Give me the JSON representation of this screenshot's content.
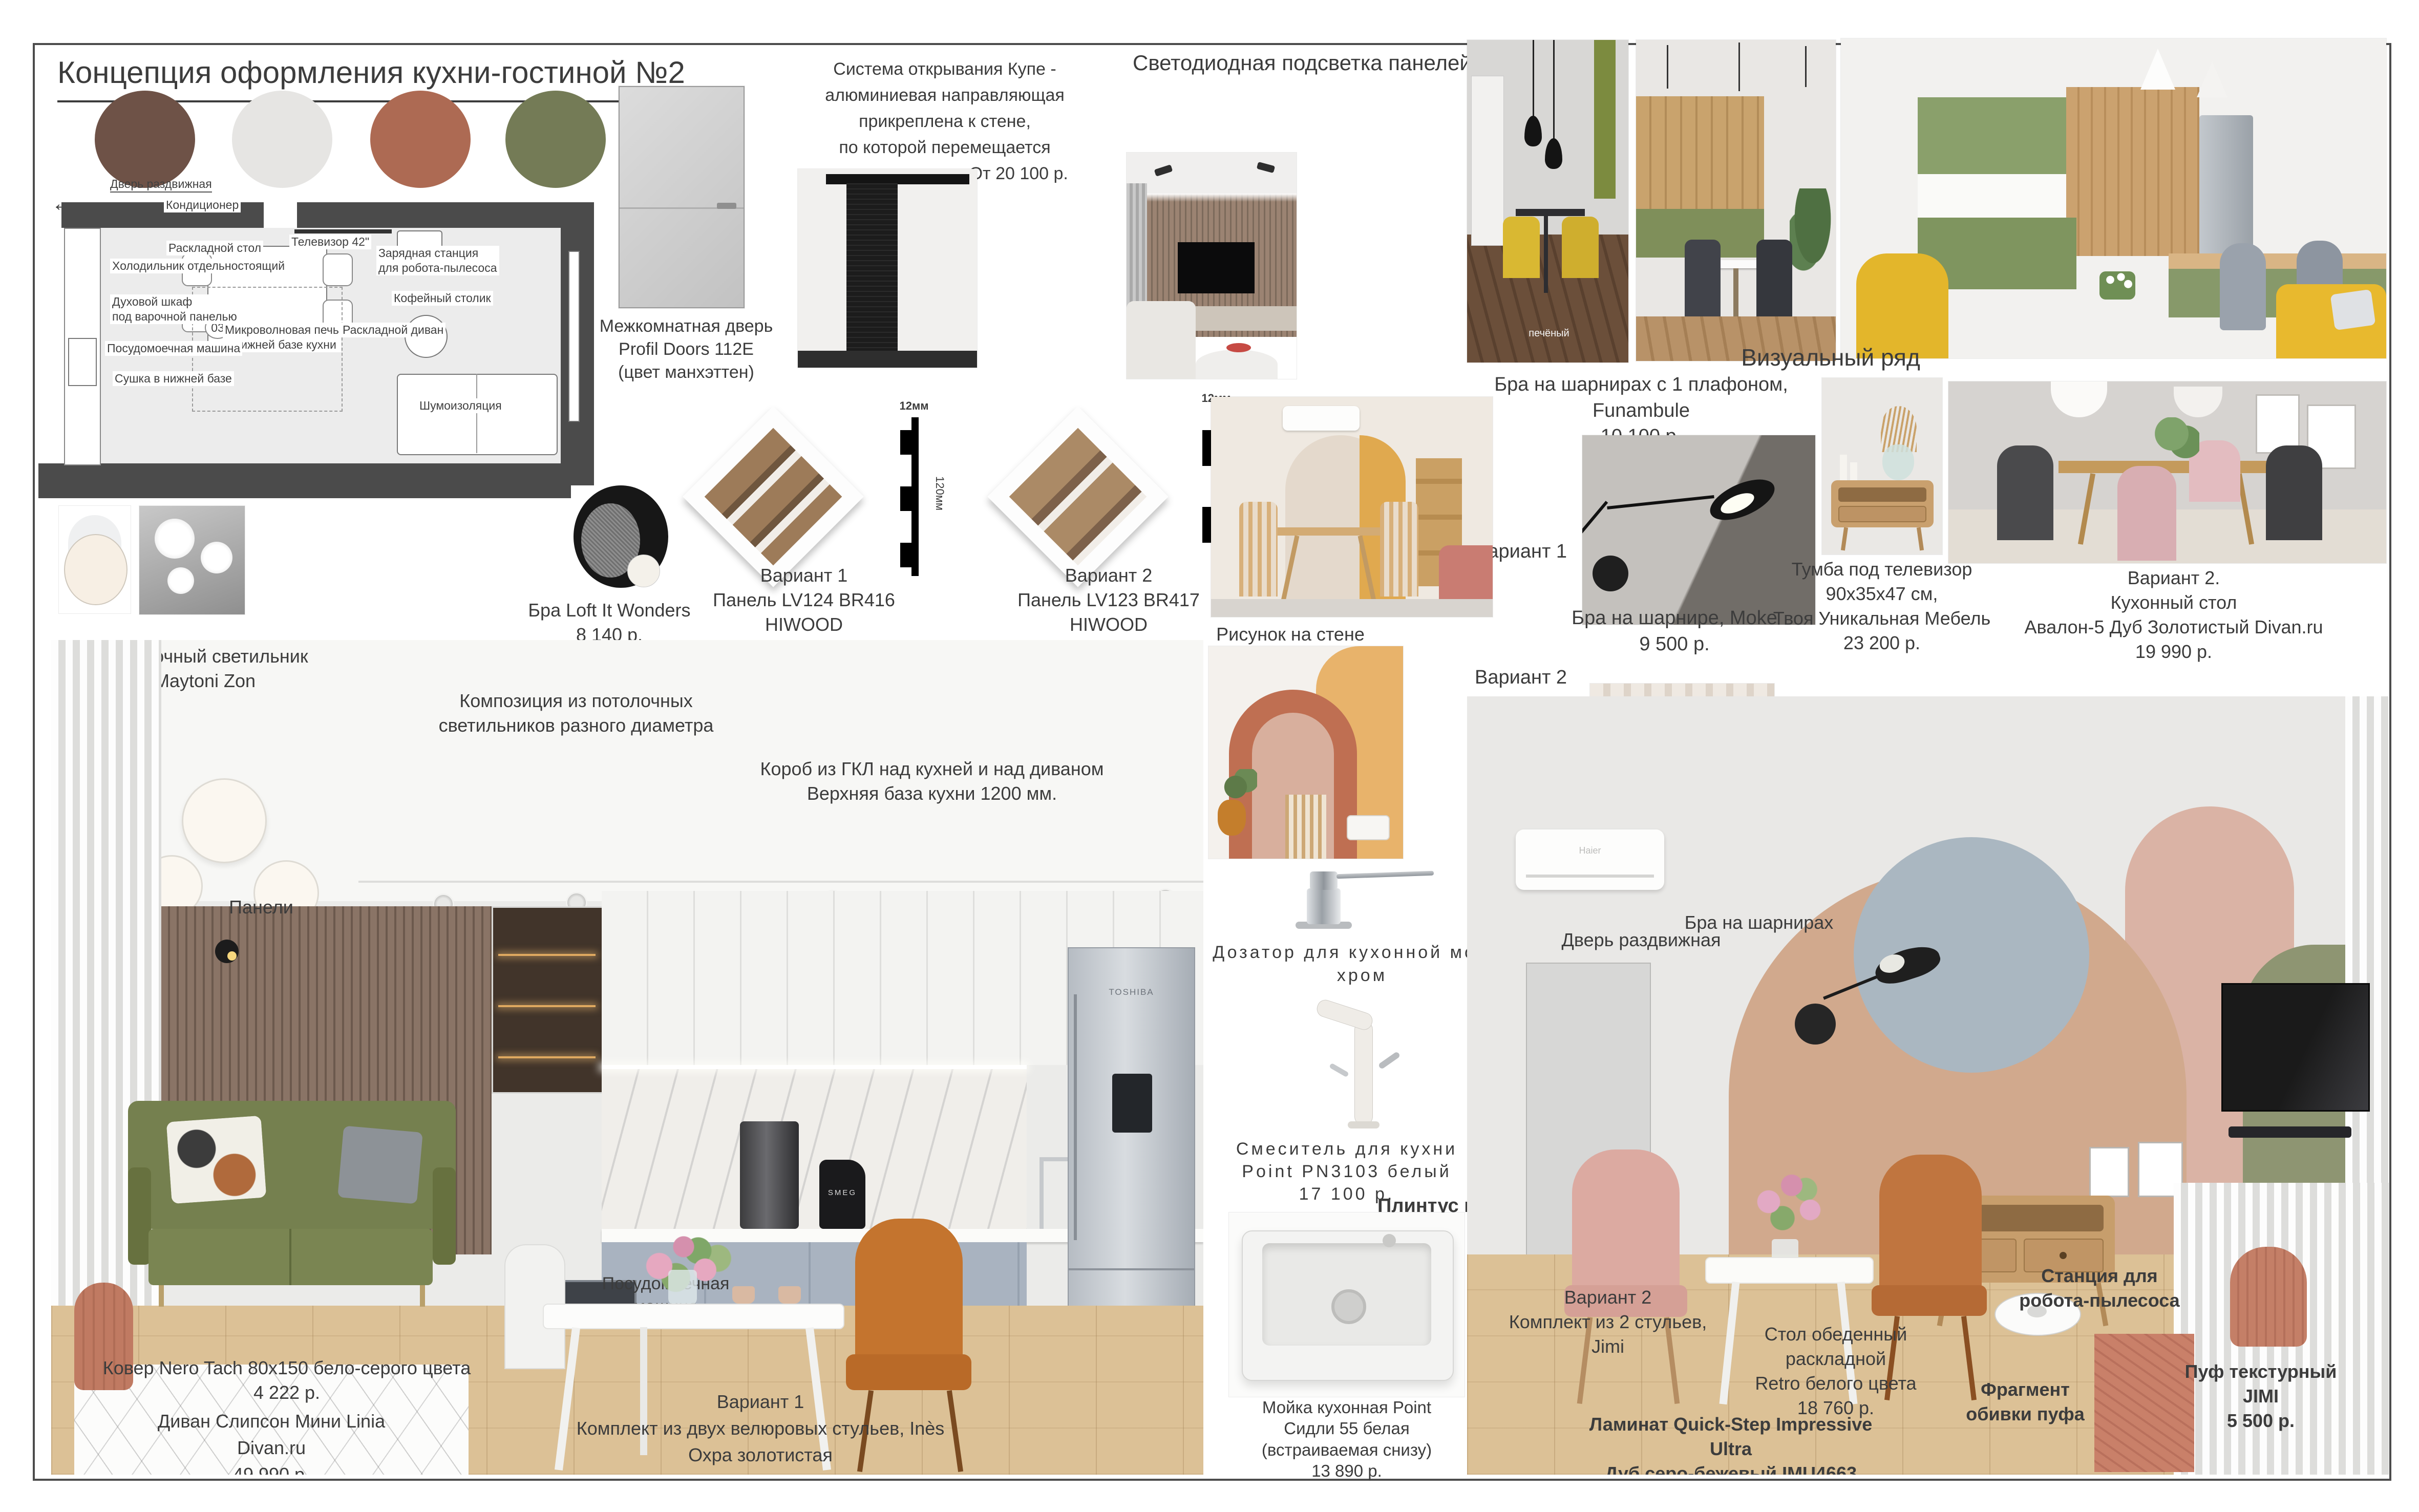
{
  "title": "Концепция оформления кухни-гостиной №2",
  "palette": {
    "c1": "#6E5247",
    "c2": "#E6E5E3",
    "c3": "#AD6A53",
    "c4": "#747B56"
  },
  "plan": {
    "door": "Дверь раздвижная",
    "ac": "Кондиционер",
    "tv": "Телевизор 42\"",
    "table": "Раскладной стол",
    "fridge": "Холодильник отдельностоящий",
    "station": "Зарядная станция\nдля робота-пылесоса",
    "oven": "Духовой шкаф\nпод варочной панелью",
    "coffee": "Кофейный столик",
    "micro": "Микроволновая печь\nв нижней базе кухни",
    "sofa": "Раскладной диван",
    "dw": "Посудомоечная машина",
    "dry": "Сушка в нижней базе",
    "noise": "Шумоизоляция",
    "badge": "03",
    "arrow": "←"
  },
  "door_label": "Межкомнатная дверь\nProfil Doors 112E\n(цвет манхэттен)",
  "sliding": "Система открывания  Купе -\nалюминиевая направляющая\nприкреплена к стене,\nпо которой перемещается\nдверное полотно. От 20 100 р.",
  "led_title": "Светодиодная подсветка панелей",
  "loft": "Бра Loft It Wonders\n8 140 р.",
  "panel_v1": "Вариант 1\nПанель LV124 BR416 HIWOOD\n2 950 р./шт.",
  "panel_v2": "Вариант 2\nПанель LV123 BR417 HIWOOD\n2 950 р./шт.",
  "dim12": "12мм",
  "dim120": "120мм",
  "visual_title": "Визуальный ряд",
  "wm1": "печёный",
  "wm2": "f.me/decor_journal",
  "funambule": "Бра на шарнирах с 1 плафоном, Funambule\n10 100 р.",
  "v1": "Вариант 1",
  "v2": "Вариант 2",
  "moke": "Бра на шарнире, Moke\n9 500 р.",
  "tvstand": "Тумба под телевизор\n90х35х47 см,\nТвоя Уникальная Мебель\n23 200 р.",
  "ktable2": "Вариант 2.\nКухонный стол\nАвалон-5 Дуб Золотистый Divan.ru\n19 990 р.",
  "maytoni": "Потолочный светильник\nMaytoni Zon",
  "composition": "Композиция из потолочных\nсветильников разного диаметра",
  "gkl": "Короб из ГКЛ над кухней и над диваном\nВерхняя база кухни 1200 мм.",
  "panels_lbl": "Панели",
  "dw2": "Посудомоечная\nмашина",
  "smeg": "SMEG",
  "toshiba": "TOSHIBA",
  "haier": "Haier",
  "wallart": "Рисунок на стене",
  "dispenser": "Дозатор для кухонной мойки\nхром",
  "mixer": "Смеситель для кухни\nPoint PN3103 белый\n17 100 р.",
  "plinth": "Плинтус в цвет стен",
  "sink": "Мойка кухонная Point\nСидли 55 белая\n(встраиваемая снизу)\n13 890 р.",
  "door2": "Дверь раздвижная",
  "bra2": "Бра на шарнирах",
  "rug": "Ковер Nero Tach 80х150 бело-серого цвета\n4 222 р.",
  "sofa_lbl": "Диван Слипсон Мини Linia\nDivan.ru\n49 990 р.",
  "chairs1": "Вариант 1\nКомплект из двух велюровых стульев, Inès\nОхра золотистая\n21 200 р. (за 2 шт.)",
  "chairs2": "Вариант 2\nКомплект из 2 стульев, Jimi",
  "rtable": "Стол обеденный раскладной\nRetro белого цвета\n18 760 р.",
  "laminate": "Ламинат Quick-Step Impressive Ultra\nДуб серо-бежевый IMU4663\n2 135 р./м2",
  "station": "Станция для\nробота-пылесоса",
  "fabric": "Фрагмент\nобивки пуфа",
  "pouf": "Пуф текстурный\nJIMI\n5 500 р."
}
